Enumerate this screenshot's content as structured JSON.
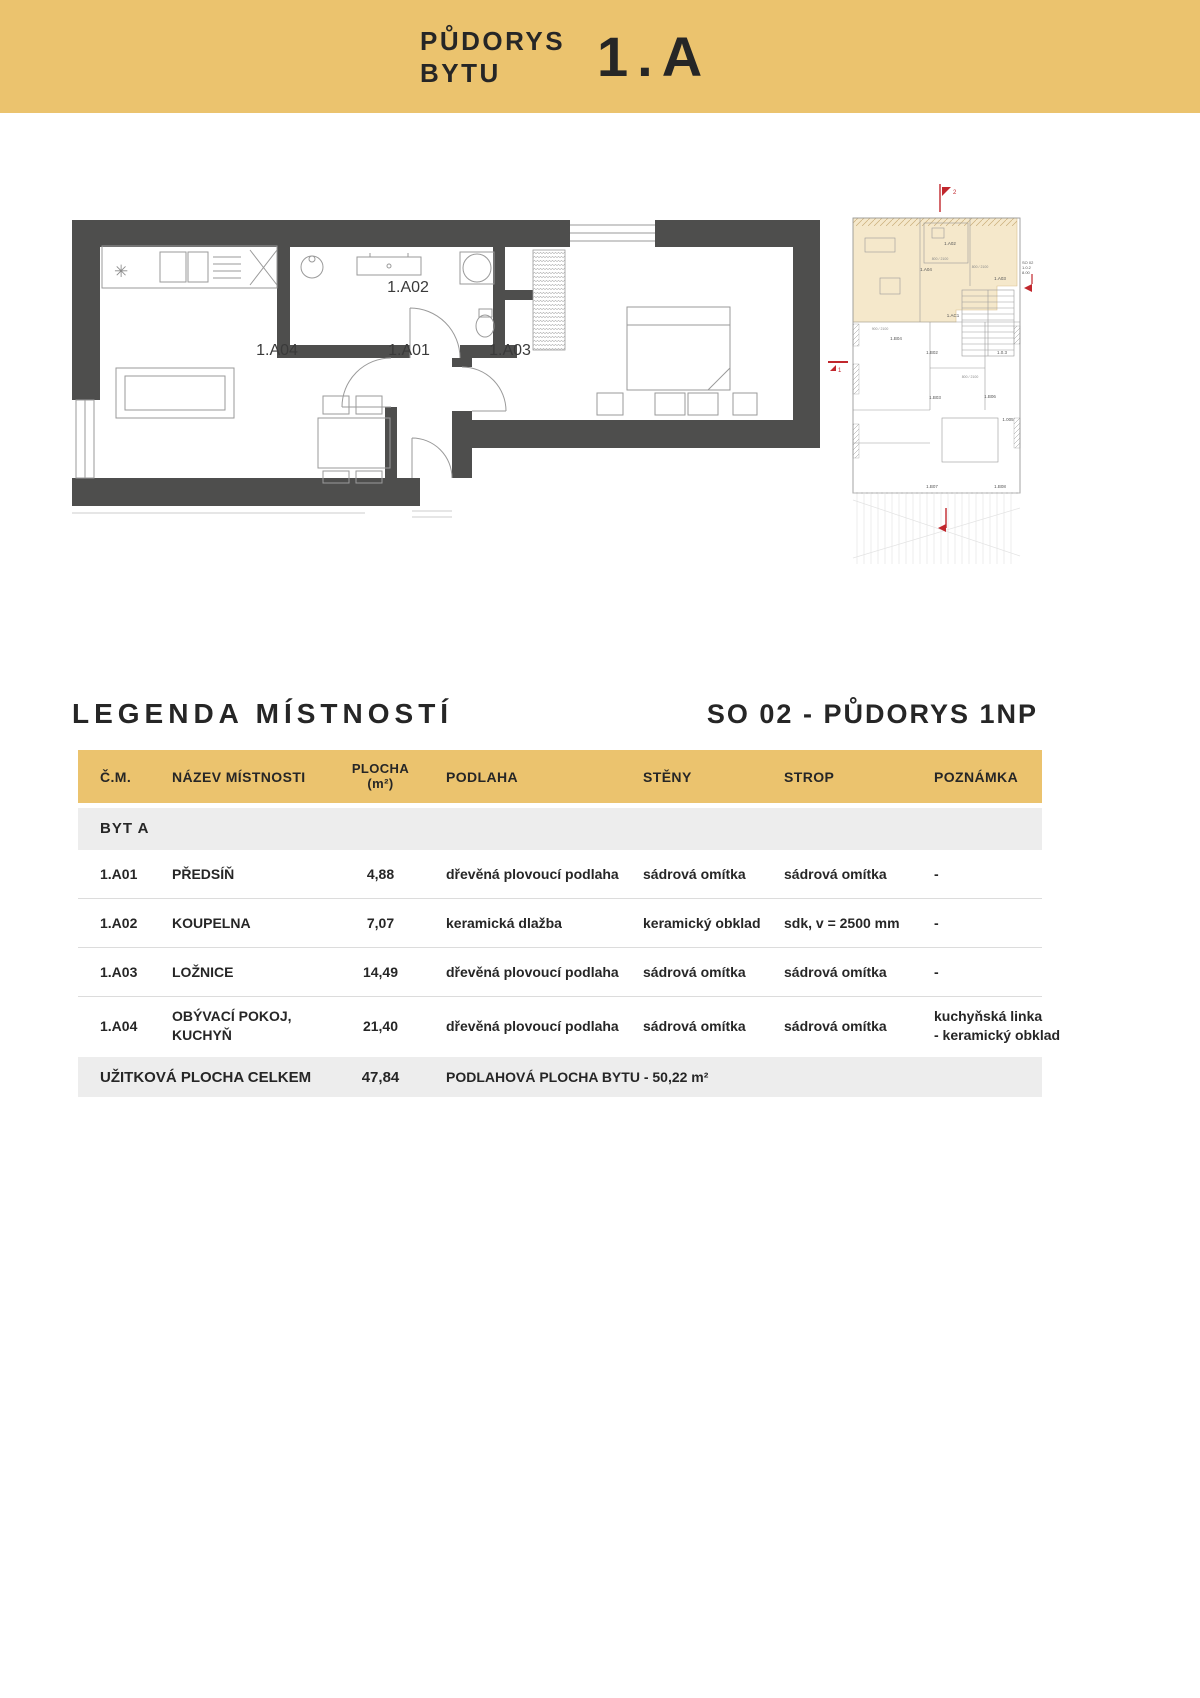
{
  "colors": {
    "gold": "#EBC36E",
    "ink": "#262626",
    "wall": "#4E4E4D",
    "beige_highlight": "#F5E8CB",
    "beige_border": "#D9BF8F",
    "red_marker": "#C1272D",
    "row_gray": "#EDEDED",
    "separator": "#DCDCDC",
    "plan_line": "#9A9A9A"
  },
  "banner": {
    "title_line1": "PŮDORYS",
    "title_line2": "BYTU",
    "unit": "1.A"
  },
  "plan": {
    "labels": [
      "1.A02",
      "1.A04",
      "1.A01",
      "1.A03"
    ]
  },
  "overview": {
    "labels": [
      "1.A02",
      "1.A04",
      "1.A03",
      "1.AC1",
      "1.B04",
      "1.B02",
      "1.0.3",
      "1.B03",
      "1.B06",
      "1.005",
      "1.B07",
      "1.B08"
    ],
    "dims": [
      "800 / 2100",
      "800 / 2100",
      "900 / 2100",
      "800 / 2100"
    ],
    "so_block": [
      "SO 02",
      "1.0.2",
      "8.00"
    ],
    "marks": {
      "top": "2",
      "left": "1"
    }
  },
  "legend": {
    "title": "LEGENDA MÍSTNOSTÍ",
    "subtitle": "SO 02 - PŮDORYS 1NP"
  },
  "table": {
    "columns": {
      "cm": "Č.M.",
      "nazev": "NÁZEV MÍSTNOSTI",
      "plocha1": "PLOCHA",
      "plocha2": "(m²)",
      "podlaha": "PODLAHA",
      "steny": "STĚNY",
      "strop": "STROP",
      "poznamka": "POZNÁMKA"
    },
    "section": "BYT A",
    "rows": [
      {
        "cm": "1.A01",
        "nazev": "PŘEDSÍŇ",
        "plocha": "4,88",
        "podlaha": "dřevěná plovoucí podlaha",
        "steny": "sádrová omítka",
        "strop": "sádrová omítka",
        "poznamka": "-"
      },
      {
        "cm": "1.A02",
        "nazev": "KOUPELNA",
        "plocha": "7,07",
        "podlaha": "keramická dlažba",
        "steny": "keramický obklad",
        "strop": "sdk, v = 2500 mm",
        "poznamka": "-"
      },
      {
        "cm": "1.A03",
        "nazev": "LOŽNICE",
        "plocha": "14,49",
        "podlaha": "dřevěná plovoucí podlaha",
        "steny": "sádrová omítka",
        "strop": "sádrová omítka",
        "poznamka": "-"
      },
      {
        "cm": "1.A04",
        "nazev": "OBÝVACÍ POKOJ,",
        "nazev2": "KUCHYŇ",
        "plocha": "21,40",
        "podlaha": "dřevěná plovoucí podlaha",
        "steny": "sádrová omítka",
        "strop": "sádrová omítka",
        "poznamka": "kuchyňská linka",
        "poznamka2": "- keramický obklad"
      }
    ],
    "footer": {
      "label": "UŽITKOVÁ PLOCHA CELKEM",
      "plocha": "47,84",
      "note": "PODLAHOVÁ PLOCHA BYTU - 50,22 m²"
    }
  }
}
